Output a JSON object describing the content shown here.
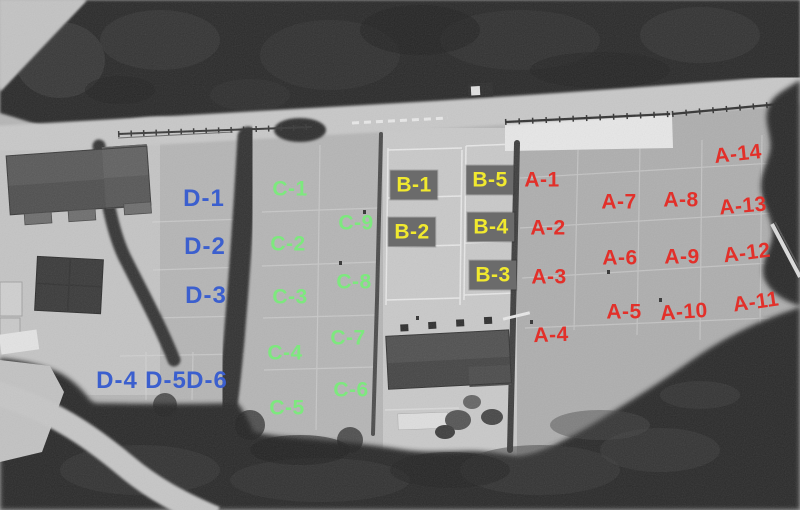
{
  "scene": {
    "type": "grayscale aerial photograph",
    "description": "Bird's-eye drone photo of a terraced parking / storage yard bordered by trees, annotated with four color-coded zone groups",
    "zone_colors": {
      "A": "#e2302a",
      "B": "#f1e92f",
      "C": "#7de87e",
      "D": "#3b5fce"
    }
  },
  "zones": [
    {
      "id": "A",
      "color": "#e2302a",
      "pad_color": null,
      "labels": [
        {
          "text": "A-1",
          "x": 542,
          "y": 180,
          "rot": 0
        },
        {
          "text": "A-2",
          "x": 548,
          "y": 228,
          "rot": 0
        },
        {
          "text": "A-3",
          "x": 549,
          "y": 277,
          "rot": 0
        },
        {
          "text": "A-4",
          "x": 551,
          "y": 335,
          "rot": -2
        },
        {
          "text": "A-5",
          "x": 624,
          "y": 312,
          "rot": 0
        },
        {
          "text": "A-6",
          "x": 620,
          "y": 258,
          "rot": 0
        },
        {
          "text": "A-7",
          "x": 619,
          "y": 202,
          "rot": 0
        },
        {
          "text": "A-8",
          "x": 681,
          "y": 200,
          "rot": 0
        },
        {
          "text": "A-9",
          "x": 682,
          "y": 257,
          "rot": 0
        },
        {
          "text": "A-10",
          "x": 684,
          "y": 312,
          "rot": -4
        },
        {
          "text": "A-11",
          "x": 756,
          "y": 302,
          "rot": -8
        },
        {
          "text": "A-12",
          "x": 747,
          "y": 253,
          "rot": -7
        },
        {
          "text": "A-13",
          "x": 743,
          "y": 206,
          "rot": -5
        },
        {
          "text": "A-14",
          "x": 738,
          "y": 154,
          "rot": -6
        }
      ]
    },
    {
      "id": "B",
      "color": "#f1e92f",
      "pad_color": "#6b6b6b",
      "labels": [
        {
          "text": "B-1",
          "x": 414,
          "y": 185,
          "rot": 0
        },
        {
          "text": "B-2",
          "x": 412,
          "y": 232,
          "rot": 0
        },
        {
          "text": "B-3",
          "x": 493,
          "y": 275,
          "rot": 0
        },
        {
          "text": "B-4",
          "x": 491,
          "y": 227,
          "rot": 0
        },
        {
          "text": "B-5",
          "x": 490,
          "y": 180,
          "rot": 0
        }
      ]
    },
    {
      "id": "C",
      "color": "#7de87e",
      "pad_color": null,
      "labels": [
        {
          "text": "C-1",
          "x": 290,
          "y": 189,
          "rot": 0
        },
        {
          "text": "C-2",
          "x": 288,
          "y": 244,
          "rot": 0
        },
        {
          "text": "C-3",
          "x": 290,
          "y": 297,
          "rot": 0
        },
        {
          "text": "C-4",
          "x": 285,
          "y": 353,
          "rot": 0
        },
        {
          "text": "C-5",
          "x": 287,
          "y": 408,
          "rot": 0
        },
        {
          "text": "C-6",
          "x": 351,
          "y": 390,
          "rot": 0
        },
        {
          "text": "C-7",
          "x": 348,
          "y": 338,
          "rot": 0
        },
        {
          "text": "C-8",
          "x": 354,
          "y": 282,
          "rot": 0
        },
        {
          "text": "C-9",
          "x": 356,
          "y": 223,
          "rot": 0
        }
      ]
    },
    {
      "id": "D",
      "color": "#3b5fce",
      "pad_color": null,
      "labels": [
        {
          "text": "D-1",
          "x": 204,
          "y": 199,
          "rot": 0
        },
        {
          "text": "D-2",
          "x": 205,
          "y": 247,
          "rot": 0
        },
        {
          "text": "D-3",
          "x": 206,
          "y": 296,
          "rot": 0
        },
        {
          "text": "D-4",
          "x": 117,
          "y": 381,
          "rot": 0
        },
        {
          "text": "D-5",
          "x": 166,
          "y": 381,
          "rot": 0
        },
        {
          "text": "D-6",
          "x": 207,
          "y": 381,
          "rot": 0
        }
      ]
    }
  ]
}
